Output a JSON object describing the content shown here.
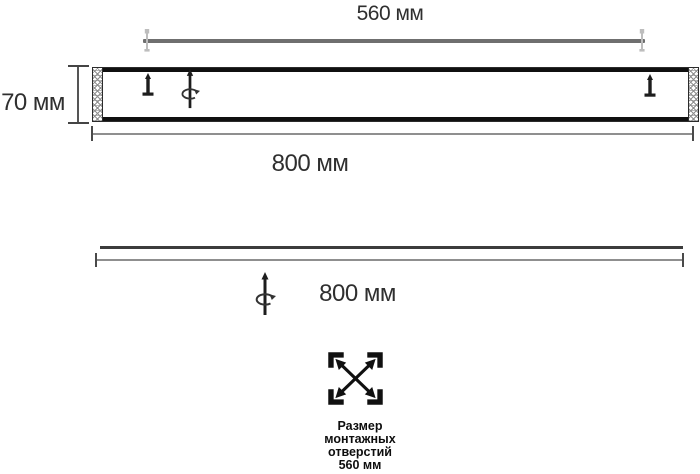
{
  "diagram": {
    "side_view": {
      "mount_width_label": "560 мм",
      "height_label": "70 мм",
      "width_label": "800 мм"
    },
    "front_view": {
      "width_label": "800 мм"
    },
    "legend": {
      "lines": [
        "Размер",
        "монтажных",
        "отверстий",
        "560 мм"
      ]
    },
    "icons": {
      "screw": "screw-icon",
      "rotation_axis": "rotate-axis-icon",
      "mount_pin": "mount-pin-icon",
      "mounting_holes": "expand-arrows-icon"
    },
    "colors": {
      "line_dark": "#1d1d1d",
      "bar_gray": "#6f6f6f",
      "dim_gray": "#8f8f8f",
      "pin_gray": "#bdbdbd",
      "text": "#2a2a2a"
    }
  }
}
